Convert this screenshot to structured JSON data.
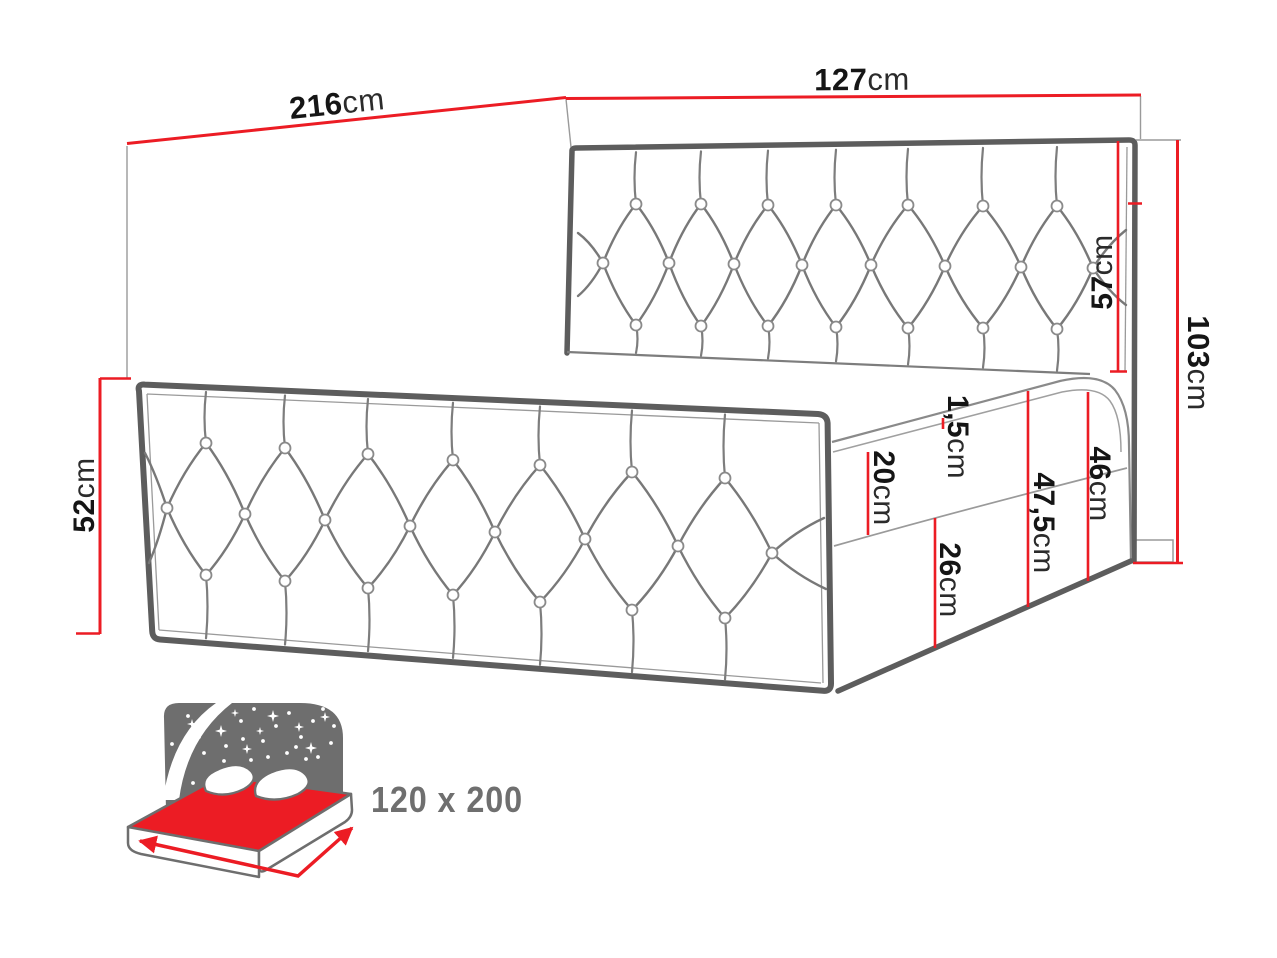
{
  "diagram": {
    "title": "bed-dimension-diagram",
    "colors": {
      "dimension_red": "#ec1c24",
      "outline_gray": "#5d5d5d",
      "icon_gray": "#6e6e6e",
      "text_black": "#151515"
    },
    "dimensions": {
      "length": {
        "value": "216",
        "unit": "cm"
      },
      "width": {
        "value": "127",
        "unit": "cm"
      },
      "headboard": {
        "value": "57",
        "unit": "cm"
      },
      "total_height": {
        "value": "103",
        "unit": "cm"
      },
      "footboard": {
        "value": "52",
        "unit": "cm"
      },
      "topper": {
        "value": "1,5",
        "unit": "cm"
      },
      "mattress": {
        "value": "20",
        "unit": "cm"
      },
      "box_front": {
        "value": "26",
        "unit": "cm"
      },
      "side_total": {
        "value": "47,5",
        "unit": "cm"
      },
      "base_height": {
        "value": "46",
        "unit": "cm"
      }
    },
    "size_badge": {
      "label": "120 x 200"
    },
    "icons": {
      "size_icon": "bed-with-starry-headboard-icon"
    }
  }
}
